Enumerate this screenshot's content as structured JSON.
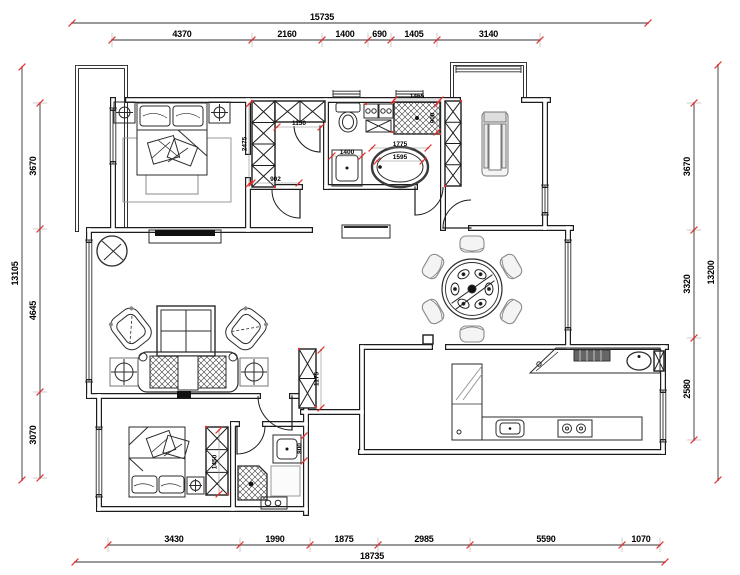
{
  "drawing_type": "apartment-floor-plan",
  "colors": {
    "wall": "#1c1c1c",
    "tick_red": "#e0312e",
    "dim_text": "#000000",
    "furniture_line": "#2b2b2b",
    "light_line": "#8a8a8a"
  },
  "dimensions": {
    "top": {
      "overall": "15735",
      "segments": [
        "4370",
        "2160",
        "1400",
        "690",
        "1405",
        "3140"
      ]
    },
    "bottom": {
      "overall": "18735",
      "segments": [
        "3430",
        "1990",
        "1875",
        "2985",
        "5590",
        "1070"
      ]
    },
    "left": {
      "overall": "13105",
      "segments": [
        "3670",
        "4645",
        "3070"
      ]
    },
    "right": {
      "overall": "13200",
      "segments": [
        "3670",
        "3320",
        "2580"
      ]
    },
    "interior": {
      "closet_depth": "2475",
      "closet_width": "1150",
      "closet_door": "902",
      "vanity_width": "1400",
      "bathtub_length": "1775",
      "bathtub_inner": "1595",
      "shower_width": "1465",
      "shower_depth": "900",
      "hall_cabinet": "1175",
      "bedroom2_wardrobe": "1450",
      "bath2_sink": "800"
    }
  }
}
